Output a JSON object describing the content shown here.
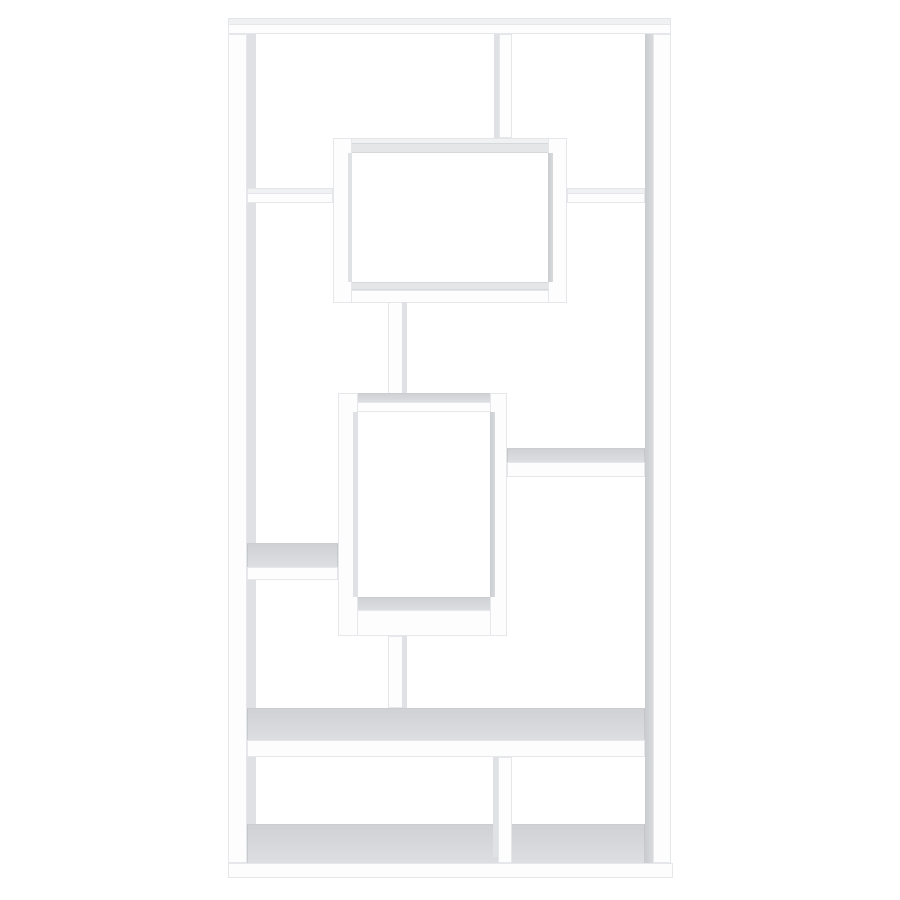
{
  "scene": {
    "type": "product-photo",
    "alt": "White contemporary geometric bookcase with ten asymmetric open shelf compartments, photographed front-on against a plain white background",
    "background_color": "#ffffff",
    "subject": "10-shelf geometric cube bookcase",
    "finish": "white",
    "text_content": "none"
  },
  "palette": {
    "background": "#ffffff",
    "board_front": "#fdfdfe",
    "board_top_bright": "#eff1f2",
    "board_top_gray": "#cfd1d4",
    "inner_shade": "#c9ccd0",
    "inner_shade_light": "#dfe1e4",
    "edge_line": "#aab0b6"
  },
  "furniture": {
    "name": "geometric-bookcase",
    "canvas": {
      "width": 900,
      "height": 900
    },
    "parts": [
      {
        "name": "frame-top-surface",
        "x": 228,
        "y": 18,
        "w": 443,
        "h": 6,
        "kind": "bright"
      },
      {
        "name": "frame-top-front",
        "x": 228,
        "y": 24,
        "w": 443,
        "h": 10,
        "kind": "front"
      },
      {
        "name": "left-post-front",
        "x": 228,
        "y": 34,
        "w": 19,
        "h": 829,
        "kind": "front"
      },
      {
        "name": "left-post-inner-shade",
        "x": 247,
        "y": 34,
        "w": 9,
        "h": 829,
        "kind": "shade-light"
      },
      {
        "name": "top-divider-shade",
        "x": 494,
        "y": 34,
        "w": 5,
        "h": 104,
        "kind": "shade-light"
      },
      {
        "name": "top-divider-front",
        "x": 499,
        "y": 34,
        "w": 13,
        "h": 104,
        "kind": "front"
      },
      {
        "name": "upper-shelf-left-surface",
        "x": 247,
        "y": 188,
        "w": 86,
        "h": 5,
        "kind": "bright"
      },
      {
        "name": "upper-shelf-left-front",
        "x": 247,
        "y": 193,
        "w": 86,
        "h": 10,
        "kind": "front"
      },
      {
        "name": "upper-shelf-right-surface",
        "x": 567,
        "y": 188,
        "w": 78,
        "h": 5,
        "kind": "bright"
      },
      {
        "name": "upper-shelf-right-front",
        "x": 567,
        "y": 193,
        "w": 78,
        "h": 10,
        "kind": "front"
      },
      {
        "name": "upper-box-bottom-surface",
        "x": 333,
        "y": 282,
        "w": 234,
        "h": 8,
        "kind": "gray-light"
      },
      {
        "name": "upper-box-bottom-front",
        "x": 333,
        "y": 290,
        "w": 234,
        "h": 13,
        "kind": "front"
      },
      {
        "name": "upper-box-top-surface",
        "x": 333,
        "y": 138,
        "w": 234,
        "h": 5,
        "kind": "bright"
      },
      {
        "name": "upper-box-top-front",
        "x": 333,
        "y": 143,
        "w": 234,
        "h": 10,
        "kind": "gray-light"
      },
      {
        "name": "upper-box-left-wall",
        "x": 333,
        "y": 138,
        "w": 19,
        "h": 165,
        "kind": "front"
      },
      {
        "name": "upper-box-left-inner-shade",
        "x": 348,
        "y": 153,
        "w": 4,
        "h": 129,
        "kind": "shade-light"
      },
      {
        "name": "upper-box-right-wall",
        "x": 548,
        "y": 138,
        "w": 19,
        "h": 165,
        "kind": "front"
      },
      {
        "name": "upper-box-right-inner-shade",
        "x": 548,
        "y": 153,
        "w": 5,
        "h": 129,
        "kind": "shade"
      },
      {
        "name": "connector-post-front",
        "x": 388,
        "y": 302,
        "w": 19,
        "h": 93,
        "kind": "front"
      },
      {
        "name": "connector-post-shade",
        "x": 402,
        "y": 302,
        "w": 5,
        "h": 93,
        "kind": "shade-light"
      },
      {
        "name": "middle-box-top-surface",
        "x": 338,
        "y": 393,
        "w": 169,
        "h": 9,
        "kind": "gray"
      },
      {
        "name": "middle-box-top-front",
        "x": 338,
        "y": 402,
        "w": 169,
        "h": 10,
        "kind": "front"
      },
      {
        "name": "middle-box-bottom-surface",
        "x": 338,
        "y": 597,
        "w": 169,
        "h": 13,
        "kind": "gray"
      },
      {
        "name": "middle-box-bottom-front",
        "x": 338,
        "y": 610,
        "w": 169,
        "h": 26,
        "kind": "front"
      },
      {
        "name": "middle-box-left-wall",
        "x": 338,
        "y": 393,
        "w": 20,
        "h": 243,
        "kind": "front"
      },
      {
        "name": "middle-box-left-inner-shade",
        "x": 353,
        "y": 412,
        "w": 5,
        "h": 185,
        "kind": "shade-light"
      },
      {
        "name": "middle-box-right-wall",
        "x": 490,
        "y": 393,
        "w": 17,
        "h": 243,
        "kind": "front"
      },
      {
        "name": "middle-box-right-inner-shade",
        "x": 490,
        "y": 412,
        "w": 5,
        "h": 185,
        "kind": "shade"
      },
      {
        "name": "right-mid-shelf-surface",
        "x": 507,
        "y": 448,
        "w": 138,
        "h": 14,
        "kind": "gray"
      },
      {
        "name": "right-mid-shelf-front",
        "x": 507,
        "y": 462,
        "w": 138,
        "h": 15,
        "kind": "front"
      },
      {
        "name": "left-mid-shelf-surface",
        "x": 247,
        "y": 543,
        "w": 91,
        "h": 24,
        "kind": "gray"
      },
      {
        "name": "left-mid-shelf-front",
        "x": 247,
        "y": 567,
        "w": 91,
        "h": 13,
        "kind": "front"
      },
      {
        "name": "lower-post-front",
        "x": 388,
        "y": 636,
        "w": 19,
        "h": 72,
        "kind": "front"
      },
      {
        "name": "lower-post-shade",
        "x": 402,
        "y": 636,
        "w": 5,
        "h": 72,
        "kind": "shade-light"
      },
      {
        "name": "big-shelf-surface",
        "x": 247,
        "y": 708,
        "w": 398,
        "h": 32,
        "kind": "gray"
      },
      {
        "name": "big-shelf-front",
        "x": 247,
        "y": 740,
        "w": 398,
        "h": 17,
        "kind": "front"
      },
      {
        "name": "bottom-floor-surface",
        "x": 247,
        "y": 824,
        "w": 398,
        "h": 39,
        "kind": "gray"
      },
      {
        "name": "bottom-divider-shade",
        "x": 493,
        "y": 757,
        "w": 5,
        "h": 100,
        "kind": "shade-light"
      },
      {
        "name": "bottom-divider-front",
        "x": 498,
        "y": 757,
        "w": 14,
        "h": 106,
        "kind": "front"
      },
      {
        "name": "base-kick-front",
        "x": 228,
        "y": 863,
        "w": 445,
        "h": 15,
        "kind": "front"
      },
      {
        "name": "right-post-inner-shade",
        "x": 645,
        "y": 34,
        "w": 8,
        "h": 829,
        "kind": "shade"
      },
      {
        "name": "right-post-front",
        "x": 653,
        "y": 34,
        "w": 18,
        "h": 829,
        "kind": "front"
      }
    ]
  }
}
